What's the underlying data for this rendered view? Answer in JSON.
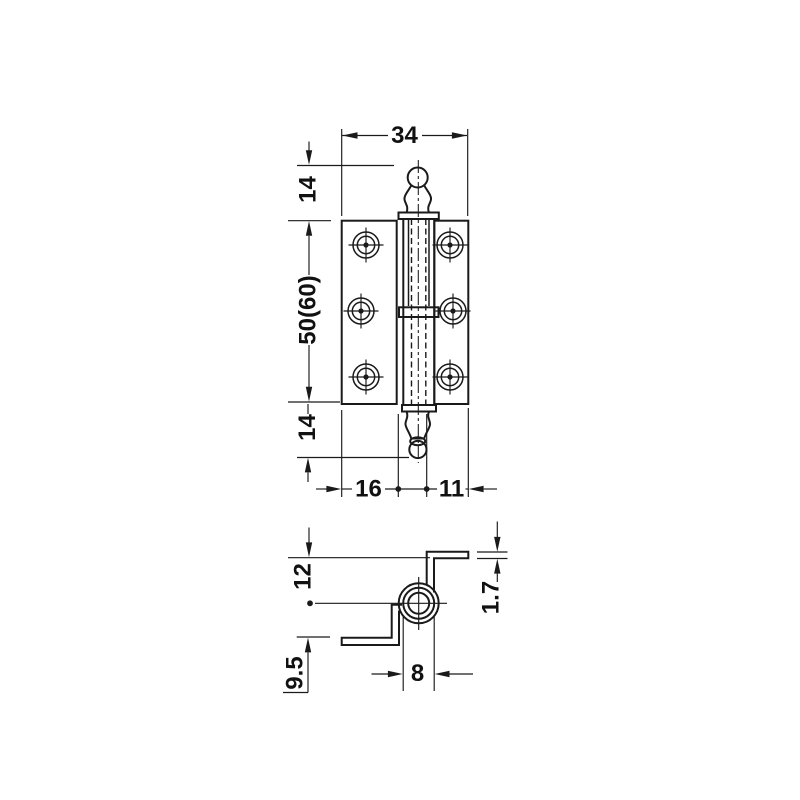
{
  "page": {
    "background_color": "#ffffff",
    "line_color": "#1a1a1a"
  },
  "front_view": {
    "name": "hinge front elevation",
    "dims": {
      "width": "34",
      "finial_top": "14",
      "leaf_height": "50(60)",
      "finial_bottom": "14",
      "leaf_offset_left": "16",
      "leaf_offset_right": "11"
    }
  },
  "section_view": {
    "name": "hinge cross section",
    "dims": {
      "axis_to_upper_leaf": "12",
      "axis_to_lower_leaf": "9.5",
      "knuckle_diameter": "8",
      "material_thickness": "1.7"
    }
  }
}
